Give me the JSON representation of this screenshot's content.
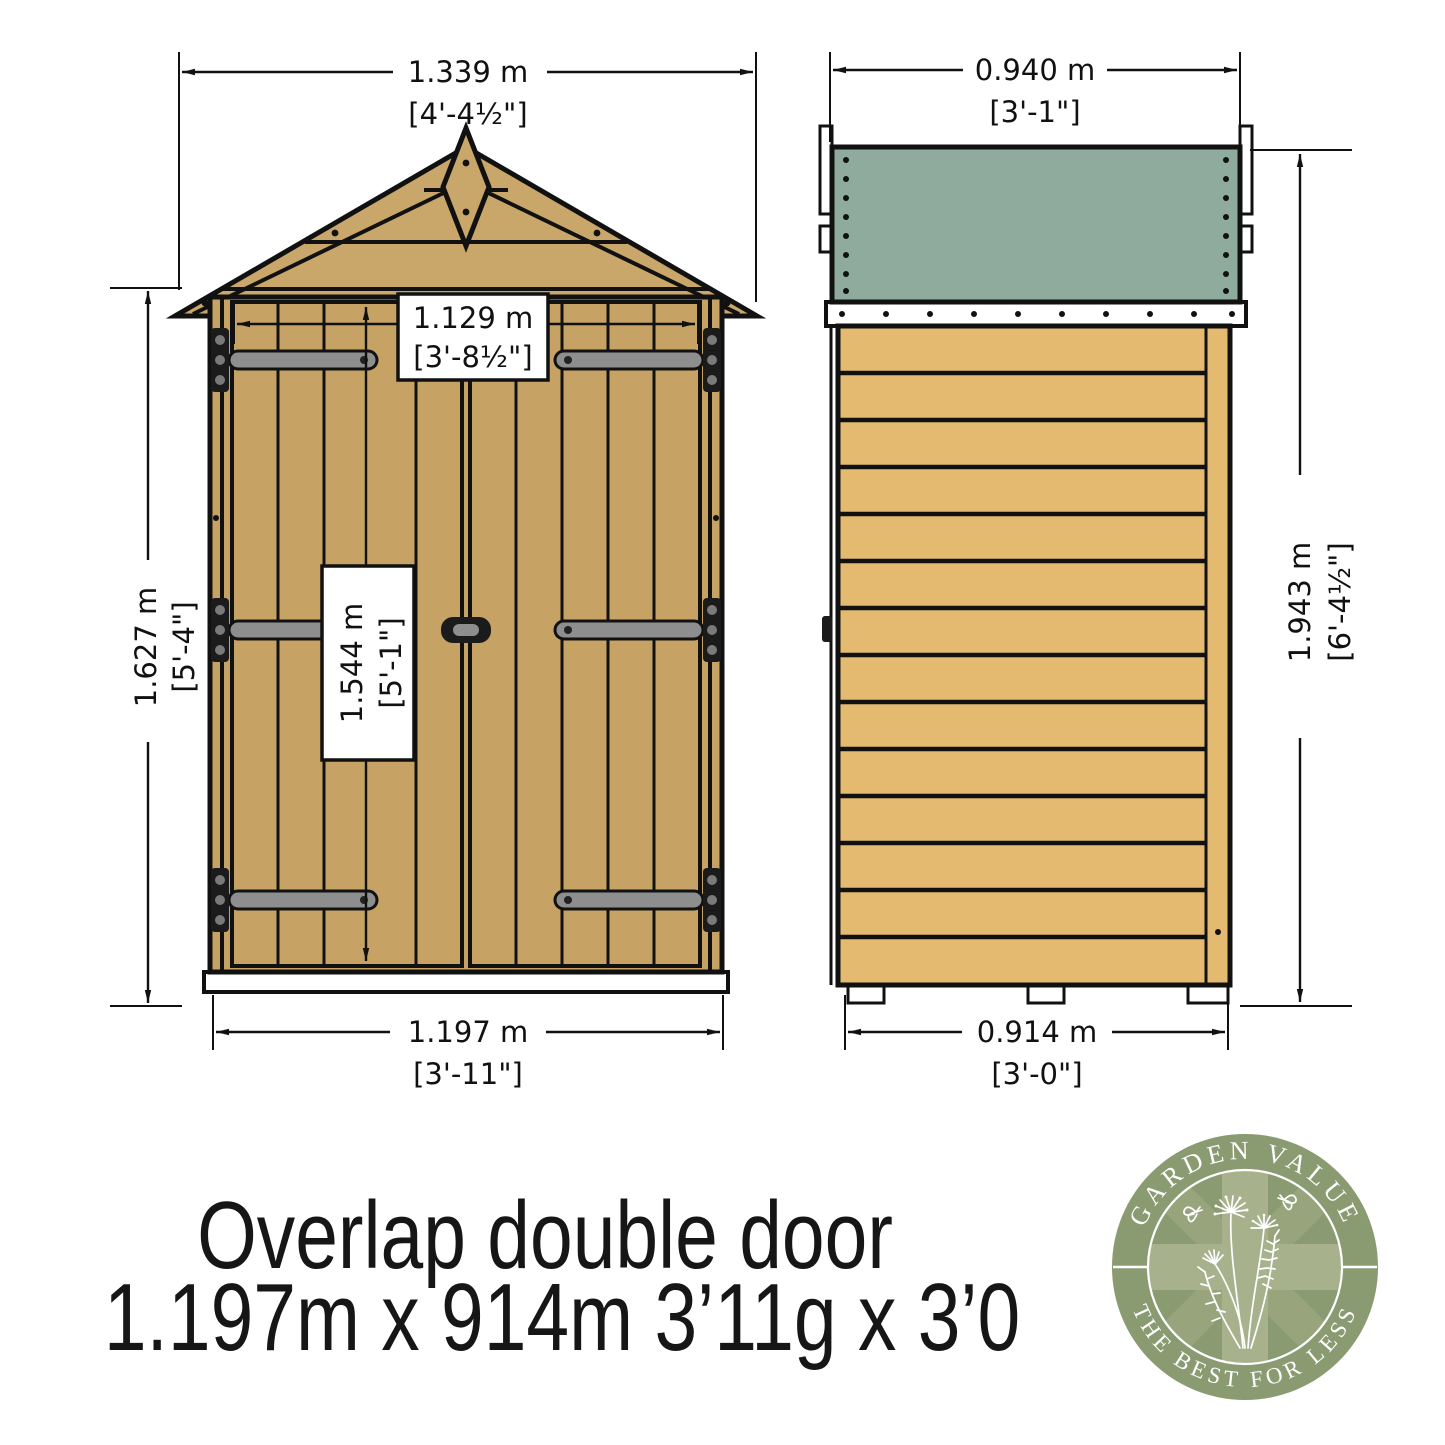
{
  "title": {
    "line1": "Overlap double door",
    "line2": "1.197m x 914m 3’11g x 3’0"
  },
  "front_view": {
    "overall_width": {
      "metric": "1.339 m",
      "imperial": "[4'-4½\"]"
    },
    "door_width": {
      "metric": "1.129 m",
      "imperial": "[3'-8½\"]"
    },
    "wall_height": {
      "metric": "1.627 m",
      "imperial": "[5'-4\"]"
    },
    "door_height": {
      "metric": "1.544 m",
      "imperial": "[5'-1\"]"
    },
    "base_width": {
      "metric": "1.197 m",
      "imperial": "[3'-11\"]"
    }
  },
  "side_view": {
    "overall_depth": {
      "metric": "0.940 m",
      "imperial": "[3'-1\"]"
    },
    "overall_height": {
      "metric": "1.943 m",
      "imperial": "[6'-4½\"]"
    },
    "base_depth": {
      "metric": "0.914 m",
      "imperial": "[3'-0\"]"
    }
  },
  "logo": {
    "arc_top": "GARDEN VALUE",
    "arc_bottom": "THE BEST FOR LESS"
  },
  "colors": {
    "front_wood": "#c6a264",
    "roof_wood": "#c9a76a",
    "side_wood": "#e3ba70",
    "trim_wood": "#d9b269",
    "felt_green": "#8fab9d",
    "fascia_green": "#7e968c",
    "badge_green": "#8a9b72",
    "jack_light": "#a7b28c",
    "jack_mid": "#97a47c",
    "line": "#111111"
  }
}
